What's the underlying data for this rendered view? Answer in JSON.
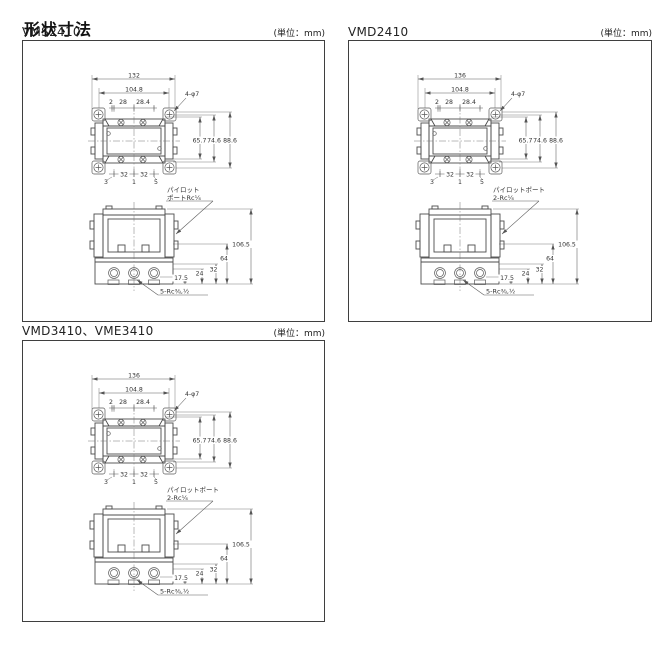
{
  "page": {
    "title": "形状寸法"
  },
  "panels": [
    {
      "model": "VMS2410",
      "unit": "(単位：mm)",
      "top_view": {
        "overall_width": "132",
        "mount_width": "104.8",
        "dim_offset": "2",
        "dim_pitch": "28",
        "dim_pitch_end": "28.4",
        "holes_label": "4-φ7",
        "height_inner": "65.7",
        "height_mid": "74.6",
        "height_outer": "88.6",
        "bottom_left": "3",
        "bottom_pitch_left": "32",
        "bottom_center": "1",
        "bottom_pitch_right": "32",
        "bottom_right": "5"
      },
      "front_view": {
        "pilot_line1": "パイロット",
        "pilot_line2": "ポートRc¼",
        "overall_height": "106.5",
        "dim_64": "64",
        "dim_32": "32",
        "dim_24": "24",
        "dim_17_5": "17.5",
        "ports_label": "5-Rc⅜,½"
      }
    },
    {
      "model": "VMD2410",
      "unit": "(単位：mm)",
      "top_view": {
        "overall_width": "136",
        "mount_width": "104.8",
        "dim_offset": "2",
        "dim_pitch": "28",
        "dim_pitch_end": "28.4",
        "holes_label": "4-φ7",
        "height_inner": "65.7",
        "height_mid": "74.6",
        "height_outer": "88.6",
        "bottom_left": "3",
        "bottom_pitch_left": "32",
        "bottom_center": "1",
        "bottom_pitch_right": "32",
        "bottom_right": "5"
      },
      "front_view": {
        "pilot_line1": "パイロットポート",
        "pilot_line2": "2-Rc¼",
        "overall_height": "106.5",
        "dim_64": "64",
        "dim_32": "32",
        "dim_24": "24",
        "dim_17_5": "17.5",
        "ports_label": "5-Rc⅜,½"
      }
    },
    {
      "model": "VMD3410、VME3410",
      "unit": "(単位：mm)",
      "top_view": {
        "overall_width": "136",
        "mount_width": "104.8",
        "dim_offset": "2",
        "dim_pitch": "28",
        "dim_pitch_end": "28.4",
        "holes_label": "4-φ7",
        "height_inner": "65.7",
        "height_mid": "74.6",
        "height_outer": "88.6",
        "bottom_left": "3",
        "bottom_pitch_left": "32",
        "bottom_center": "1",
        "bottom_pitch_right": "32",
        "bottom_right": "5"
      },
      "front_view": {
        "pilot_line1": "パイロットポート",
        "pilot_line2": "2-Rc¼",
        "overall_height": "106.5",
        "dim_64": "64",
        "dim_32": "32",
        "dim_24": "24",
        "dim_17_5": "17.5",
        "ports_label": "5-Rc⅜,½"
      }
    }
  ]
}
